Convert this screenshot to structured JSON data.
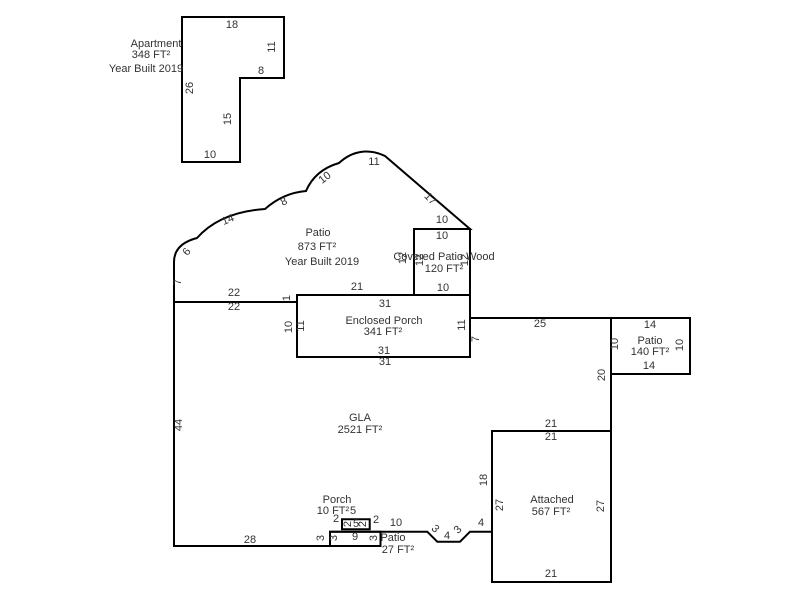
{
  "canvas": {
    "background": "#ffffff",
    "line_color": "#000000",
    "text_color": "#333333"
  },
  "shapes": [
    {
      "id": "apartment",
      "title": "Apartment",
      "area": "348 FT²",
      "year_built": "Year Built 2019",
      "labels": [
        {
          "t": "Apartment",
          "x": 156,
          "y": 44,
          "role": "name"
        },
        {
          "t": "348 FT²",
          "x": 151,
          "y": 55,
          "role": "area"
        },
        {
          "t": "Year Built 2019",
          "x": 146,
          "y": 69,
          "role": "year"
        },
        {
          "t": "18",
          "x": 232,
          "y": 25,
          "role": "dim"
        },
        {
          "t": "11",
          "x": 272,
          "y": 47,
          "r": -90,
          "role": "dim"
        },
        {
          "t": "8",
          "x": 261,
          "y": 71,
          "role": "dim"
        },
        {
          "t": "26",
          "x": 190,
          "y": 88,
          "r": -90,
          "role": "dim"
        },
        {
          "t": "15",
          "x": 228,
          "y": 119,
          "r": -90,
          "role": "dim"
        },
        {
          "t": "10",
          "x": 210,
          "y": 155,
          "role": "dim"
        }
      ]
    },
    {
      "id": "patio-873",
      "title": "Patio",
      "area": "873 FT²",
      "year_built": "Year Built 2019",
      "labels": [
        {
          "t": "Patio",
          "x": 318,
          "y": 233,
          "role": "name"
        },
        {
          "t": "873 FT²",
          "x": 317,
          "y": 247,
          "role": "area"
        },
        {
          "t": "Year Built 2019",
          "x": 322,
          "y": 262,
          "role": "year"
        },
        {
          "t": "7",
          "x": 178,
          "y": 282,
          "r": -90,
          "role": "dim"
        },
        {
          "t": "6",
          "x": 187,
          "y": 252,
          "r": -52,
          "role": "dim"
        },
        {
          "t": "14",
          "x": 228,
          "y": 220,
          "r": -22,
          "role": "dim"
        },
        {
          "t": "8",
          "x": 284,
          "y": 202,
          "r": -26,
          "role": "dim"
        },
        {
          "t": "10",
          "x": 325,
          "y": 178,
          "r": -38,
          "role": "dim"
        },
        {
          "t": "11",
          "x": 374,
          "y": 162,
          "role": "dim"
        },
        {
          "t": "17",
          "x": 430,
          "y": 199,
          "r": 46,
          "role": "dim"
        },
        {
          "t": "10",
          "x": 442,
          "y": 220,
          "role": "dim"
        },
        {
          "t": "12",
          "x": 403,
          "y": 258,
          "r": -90,
          "role": "dim"
        },
        {
          "t": "21",
          "x": 357,
          "y": 287,
          "role": "dim"
        },
        {
          "t": "1",
          "x": 287,
          "y": 298,
          "r": -90,
          "role": "dim"
        },
        {
          "t": "22",
          "x": 234,
          "y": 293,
          "role": "dim"
        }
      ]
    },
    {
      "id": "covered-patio-wood",
      "title": "Covered Patio Wood",
      "area": "120 FT²",
      "labels": [
        {
          "t": "10",
          "x": 442,
          "y": 236,
          "role": "dim"
        },
        {
          "t": "Covered Patio Wood",
          "x": 444,
          "y": 257,
          "role": "name"
        },
        {
          "t": "120 FT²",
          "x": 444,
          "y": 269,
          "role": "area"
        },
        {
          "t": "10",
          "x": 443,
          "y": 288,
          "role": "dim"
        },
        {
          "t": "12",
          "x": 420,
          "y": 260,
          "r": -90,
          "role": "dim"
        },
        {
          "t": "12",
          "x": 465,
          "y": 260,
          "r": -90,
          "role": "dim"
        }
      ]
    },
    {
      "id": "enclosed-porch",
      "title": "Enclosed Porch",
      "area": "341 FT²",
      "labels": [
        {
          "t": "31",
          "x": 385,
          "y": 304,
          "role": "dim"
        },
        {
          "t": "Enclosed Porch",
          "x": 384,
          "y": 321,
          "role": "name"
        },
        {
          "t": "341 FT²",
          "x": 383,
          "y": 332,
          "role": "area"
        },
        {
          "t": "31",
          "x": 384,
          "y": 351,
          "role": "dim"
        },
        {
          "t": "11",
          "x": 301,
          "y": 326,
          "r": -90,
          "role": "dim"
        },
        {
          "t": "11",
          "x": 462,
          "y": 325,
          "r": -90,
          "role": "dim"
        }
      ]
    },
    {
      "id": "patio-140",
      "title": "Patio",
      "area": "140 FT²",
      "labels": [
        {
          "t": "14",
          "x": 650,
          "y": 325,
          "role": "dim"
        },
        {
          "t": "Patio",
          "x": 650,
          "y": 341,
          "role": "name"
        },
        {
          "t": "140 FT²",
          "x": 650,
          "y": 352,
          "role": "area"
        },
        {
          "t": "14",
          "x": 649,
          "y": 366,
          "role": "dim"
        },
        {
          "t": "10",
          "x": 615,
          "y": 344,
          "r": -90,
          "role": "dim"
        },
        {
          "t": "10",
          "x": 680,
          "y": 345,
          "r": -90,
          "role": "dim"
        }
      ]
    },
    {
      "id": "gla",
      "title": "GLA",
      "area": "2521 FT²",
      "labels": [
        {
          "t": "GLA",
          "x": 360,
          "y": 418,
          "role": "name"
        },
        {
          "t": "2521 FT²",
          "x": 360,
          "y": 430,
          "role": "area"
        },
        {
          "t": "22",
          "x": 234,
          "y": 307,
          "role": "dim"
        },
        {
          "t": "10",
          "x": 289,
          "y": 327,
          "r": -90,
          "role": "dim"
        },
        {
          "t": "31",
          "x": 385,
          "y": 362,
          "role": "dim"
        },
        {
          "t": "7",
          "x": 476,
          "y": 339,
          "r": -90,
          "role": "dim"
        },
        {
          "t": "25",
          "x": 540,
          "y": 324,
          "role": "dim"
        },
        {
          "t": "20",
          "x": 602,
          "y": 375,
          "r": -90,
          "role": "dim"
        },
        {
          "t": "21",
          "x": 551,
          "y": 424,
          "role": "dim"
        },
        {
          "t": "18",
          "x": 484,
          "y": 480,
          "r": -90,
          "role": "dim"
        },
        {
          "t": "4",
          "x": 481,
          "y": 523,
          "role": "dim"
        },
        {
          "t": "3",
          "x": 458,
          "y": 530,
          "r": -45,
          "role": "dim"
        },
        {
          "t": "4",
          "x": 447,
          "y": 536,
          "role": "dim"
        },
        {
          "t": "3",
          "x": 435,
          "y": 529,
          "r": 45,
          "role": "dim"
        },
        {
          "t": "10",
          "x": 396,
          "y": 523,
          "role": "dim"
        },
        {
          "t": "2",
          "x": 376,
          "y": 520,
          "role": "dim"
        },
        {
          "t": "2",
          "x": 336,
          "y": 519,
          "role": "dim"
        },
        {
          "t": "3",
          "x": 321,
          "y": 538,
          "r": -90,
          "role": "dim"
        },
        {
          "t": "28",
          "x": 250,
          "y": 540,
          "role": "dim"
        },
        {
          "t": "44",
          "x": 179,
          "y": 425,
          "r": -90,
          "role": "dim"
        }
      ]
    },
    {
      "id": "porch",
      "title": "Porch",
      "area": "10 FT²",
      "labels": [
        {
          "t": "Porch",
          "x": 337,
          "y": 500,
          "role": "name"
        },
        {
          "t": "10 FT²",
          "x": 333,
          "y": 511,
          "role": "area"
        },
        {
          "t": "5",
          "x": 353,
          "y": 511,
          "role": "dim"
        },
        {
          "t": "2",
          "x": 348,
          "y": 524,
          "r": -90,
          "role": "dim"
        },
        {
          "t": "5",
          "x": 356,
          "y": 524,
          "role": "dim"
        },
        {
          "t": "2",
          "x": 363,
          "y": 524,
          "r": -90,
          "role": "dim"
        }
      ]
    },
    {
      "id": "patio-27",
      "title": "Patio",
      "area": "27 FT²",
      "labels": [
        {
          "t": "9",
          "x": 355,
          "y": 537,
          "role": "dim"
        },
        {
          "t": "3",
          "x": 334,
          "y": 538,
          "r": -90,
          "role": "dim"
        },
        {
          "t": "3",
          "x": 374,
          "y": 538,
          "r": -90,
          "role": "dim"
        },
        {
          "t": "Patio",
          "x": 393,
          "y": 538,
          "role": "name"
        },
        {
          "t": "27 FT²",
          "x": 398,
          "y": 550,
          "role": "area"
        }
      ]
    },
    {
      "id": "attached",
      "title": "Attached",
      "area": "567 FT²",
      "labels": [
        {
          "t": "21",
          "x": 551,
          "y": 437,
          "role": "dim"
        },
        {
          "t": "Attached",
          "x": 552,
          "y": 500,
          "role": "name"
        },
        {
          "t": "567 FT²",
          "x": 551,
          "y": 512,
          "role": "area"
        },
        {
          "t": "21",
          "x": 551,
          "y": 574,
          "role": "dim"
        },
        {
          "t": "27",
          "x": 500,
          "y": 505,
          "r": -90,
          "role": "dim"
        },
        {
          "t": "27",
          "x": 601,
          "y": 506,
          "r": -90,
          "role": "dim"
        }
      ]
    }
  ]
}
